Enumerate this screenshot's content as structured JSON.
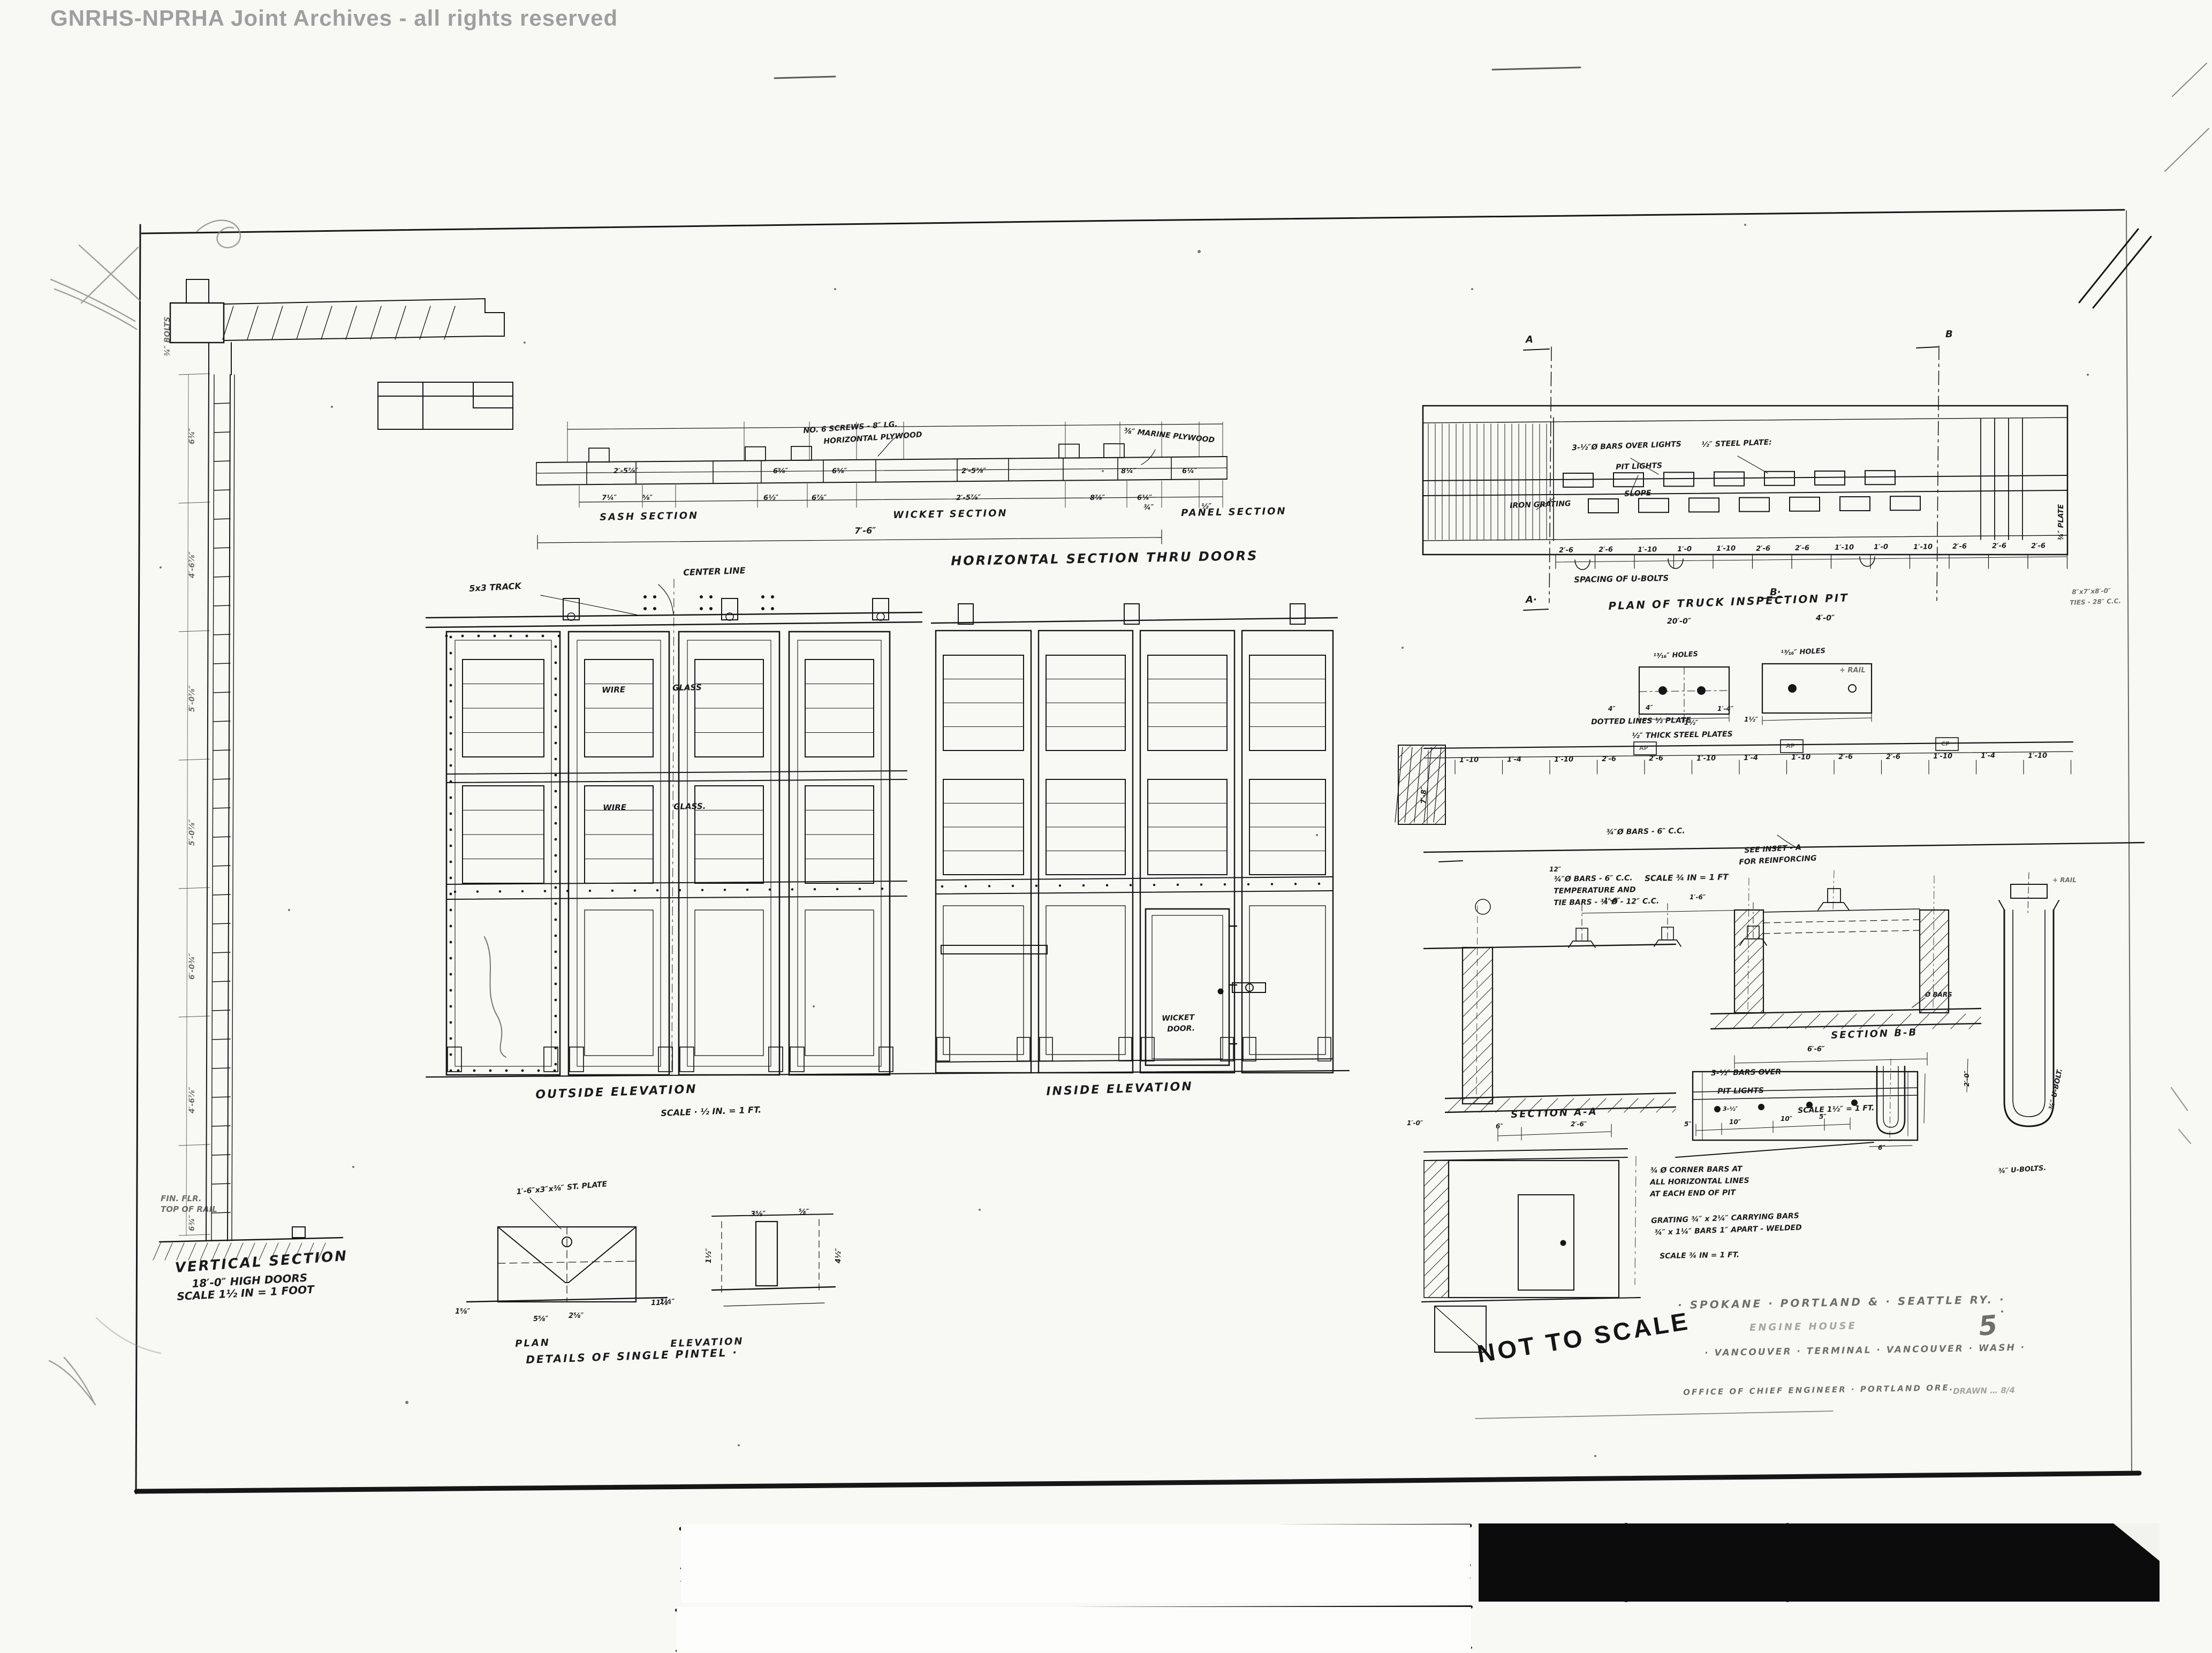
{
  "colors": {
    "ink": "#161616",
    "paper": "#f8f8f5",
    "watermark": "#9b9b9b",
    "ruler_black": "#0c0c0c"
  },
  "labels": {
    "watermark": "GNRHS-NPRHA Joint Archives - all rights reserved",
    "vsec_title": "VERTICAL SECTION",
    "vsec_sub1": "18′-0″ HIGH DOORS",
    "vsec_sub2": "SCALE 1½ IN = 1 FOOT",
    "vsec_finflr": "FIN. FLR.",
    "vsec_toprail": "TOP OF RAIL",
    "vsec_bolts": "¾″ BOLTS",
    "vd1": "6¾″",
    "vd2": "4′-6⅞″",
    "vd3": "5′-0⅞″",
    "vd4": "5′-0⅞″",
    "vd5": "6′-0¾″",
    "vd6": "4′-6⅞″",
    "vd7": "6¾″",
    "hsec_title": "HORIZONTAL SECTION THRU DOORS",
    "hsec_sash": "SASH SECTION",
    "hsec_wicket": "WICKET SECTION",
    "hsec_panel": "PANEL SECTION",
    "hsec_76": "7′-6″",
    "hsec_screws1": "NO. 6 SCREWS - 8″ LG.",
    "hsec_screws2": "HORIZONTAL PLYWOOD",
    "hsec_ply": "⅜″ MARINE PLYWOOD",
    "hsec_d34": "¾″",
    "hsec_d12": "½″",
    "oel_title": "OUTSIDE ELEVATION",
    "oel_scale": "SCALE · ½ IN. = 1 FT.",
    "track_label": "5x3 TRACK",
    "center_line": "CENTER LINE",
    "wire1a": "WIRE",
    "wire1b": "GLASS",
    "wire2a": "WIRE",
    "wire2b": "GLASS.",
    "iel_title": "INSIDE ELEVATION",
    "wicket1": "WICKET",
    "wicket2": "DOOR.",
    "pintel_note": "1′-6″x3″x⅜″ ST. PLATE",
    "pd1": "1⅝″",
    "pd2": "5⅝″",
    "pd3": "2⅝″",
    "pd4": "1¼″",
    "pd5": "3⅝″",
    "pd6": "⅝″",
    "pd7": "1½″",
    "pd8": "11⅞″",
    "pd9": "4½″",
    "pintel_plan": "PLAN",
    "pintel_elev": "ELEVATION",
    "pintel_title": "DETAILS OF SINGLE PINTEL ·",
    "pit_title": "PLAN OF TRUCK INSPECTION PIT",
    "pit_200": "20′-0″",
    "pit_bars": "3-½″Ø BARS OVER LIGHTS",
    "pit_plate": "½″ STEEL PLATE:",
    "pit_lights": "PIT LIGHTS",
    "pit_slope": "SLOPE",
    "pit_grating": "IRON GRATING",
    "pit_spacing": "SPACING OF U-BOLTS",
    "pit_ties1": "8″x7″x8′-0″",
    "pit_ties2": "TIES - 28″ C.C.",
    "pit_40": "4′-0″",
    "pit_a_top": "A",
    "pit_a_bot": "A·",
    "pit_b_top": "B",
    "pit_b_bot": "B·",
    "plate_rot": "¾″ PLATE",
    "rail_cl": "+ RAIL",
    "holes1": "¹³⁄₁₆″ HOLES",
    "holes2": "¹³⁄₁₆″ HOLES",
    "dotted_note": "DOTTED LINES ½ PLATE",
    "thick_note": "½″ THICK STEEL PLATES",
    "inset_14": "1′-4″",
    "inset_112a": "1½″",
    "inset_112b": "1½″",
    "inset_4a": "4″",
    "inset_4b": "4″",
    "band_bars": "¾″Ø BARS - 6″ C.C.",
    "band_78": "7′-8″",
    "tag1": "AP",
    "tag2": "AP",
    "tag3": "CP",
    "see_inset1": "SEE INSET - A",
    "see_inset2": "FOR REINFORCING",
    "seca_12": "12″",
    "seca_bars1": "¾″Ø BARS - 6″ C.C.",
    "seca_bars2": "TEMPERATURE AND",
    "seca_bars3": "TIE BARS - ¾″Ø - 12″ C.C.",
    "seca_scale": "SCALE ¾ IN = 1 FT",
    "seca_16a": "1′-6″",
    "seca_16b": "1′-6″",
    "seca_title": "SECTION A-A",
    "seca_6": "6″",
    "seca_26": "2′-6″",
    "seca_10": "1′-0″",
    "secb_title": "SECTION B-B",
    "secb_66": "6′-6″",
    "secb_bars": "Ø BARS",
    "secb_20": "2′-0″",
    "ubolt_rot": "¾″ U-BOLT.",
    "ubolt_lbl": "¾″ U-BOLTS.",
    "ubolt_6": "6″",
    "clrail": "+ RAIL",
    "pld1": "3-½″ BARS OVER",
    "pld2": "PIT LIGHTS",
    "pld_5a": "5″",
    "pld_10a": "10″",
    "pld_mid": "3-½″",
    "pld_10b": "10″",
    "pld_5b": "5″",
    "pld_scale": "SCALE 1½″ = 1 FT.",
    "corner1": "¾ Ø CORNER BARS AT",
    "corner2": "ALL HORIZONTAL LINES",
    "corner3": "AT EACH END OF PIT",
    "grating1": "GRATING ¾″ x 2¼″ CARRYING BARS",
    "grating2": "¾″ x 1¼″ BARS 1″ APART - WELDED",
    "grating_scale": "SCALE ¾ IN = 1 FT.",
    "stamp": "NOT TO SCALE",
    "tb1": "· SPOKANE · PORTLAND & · SEATTLE RY. ·",
    "tb2": "ENGINE HOUSE",
    "tb_sheet": "5",
    "tb3": "· VANCOUVER · TERMINAL · VANCOUVER · WASH ·",
    "tb4": "OFFICE OF CHIEF ENGINEER · PORTLAND ORE.",
    "tb4b": "DRAWN … 8/4",
    "brand": "No.18"
  },
  "dims": {
    "hsec_top": [
      "2′-5⅞″",
      "6⅝″",
      "6⅝″",
      "2′-5⅞″",
      "8¼″",
      "6¼″"
    ],
    "hsec_bot": [
      "7¼″",
      "⅝″",
      "6½″",
      "6⅞″",
      "2′-5⅞″",
      "8⅞″",
      "6¼″"
    ],
    "pit": [
      "2′-6",
      "2′-6",
      "1′-10",
      "1′-0",
      "1′-10",
      "2′-6",
      "2′-6",
      "1′-10",
      "1′-0",
      "1′-10",
      "2′-6",
      "2′-6",
      "2′-6"
    ],
    "band": [
      "1′-10",
      "1′-4",
      "1′-10",
      "2′-6",
      "2′-6",
      "1′-10",
      "1′-4",
      "1′-10",
      "2′-6",
      "2′-6",
      "1′-10",
      "1′-4",
      "1′-10"
    ]
  },
  "ruler": {
    "top_numbers": [
      "1",
      "2",
      "3",
      "4",
      "5",
      "6"
    ],
    "bottom_numbers": [
      "15",
      "14",
      "13",
      "12",
      "11",
      "10",
      "9",
      "8",
      "7",
      "6",
      "5",
      "4",
      "3",
      "2",
      "1"
    ],
    "unit": "cm",
    "brand": "No.18"
  }
}
